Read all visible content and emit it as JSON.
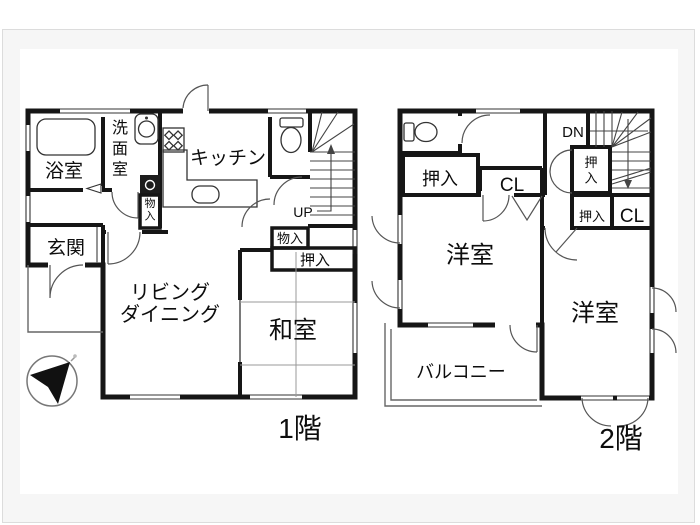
{
  "floor1": {
    "label": "1階",
    "rooms": {
      "bathroom": "浴室",
      "washroom": "洗面室",
      "kitchen": "キッチン",
      "entrance": "玄関",
      "living": "リビング\nダイニング",
      "japanese_room": "和室"
    },
    "closets": {
      "washroom_storage": "物入",
      "hall_storage": "物入",
      "oshiire": "押入"
    },
    "stairs": {
      "up": "UP"
    }
  },
  "floor2": {
    "label": "2階",
    "rooms": {
      "western_left": "洋室",
      "western_right": "洋室",
      "balcony": "バルコニー"
    },
    "closets": {
      "oshiire_left": "押入",
      "closet_left": "CL",
      "oshiire_tall": "押入",
      "oshiire_small": "押入",
      "closet_right": "CL"
    },
    "stairs": {
      "down": "DN"
    }
  },
  "colors": {
    "wall": "#161616",
    "frame_border": "#dcdcdc",
    "frame_bg": "#f6f6f6",
    "paper": "#ffffff"
  }
}
